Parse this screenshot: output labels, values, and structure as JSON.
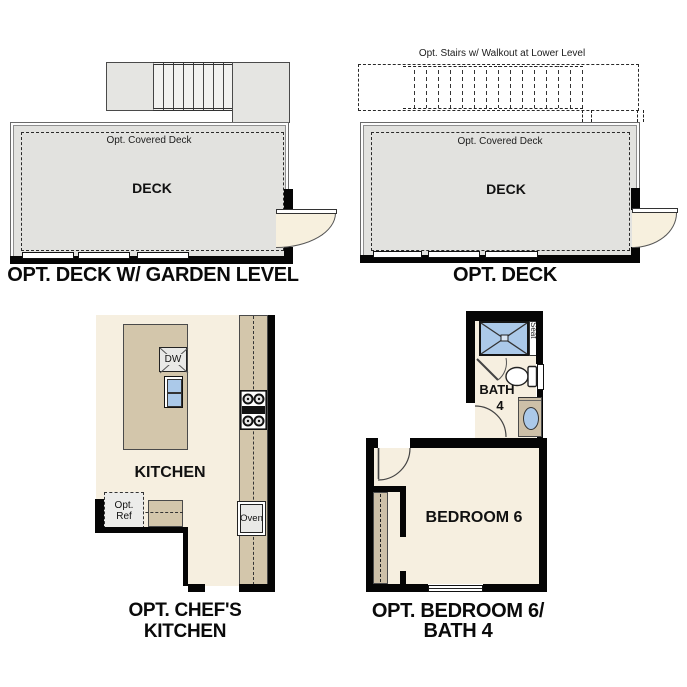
{
  "panels": {
    "deck_garden": {
      "title": "OPT. DECK W/ GARDEN LEVEL",
      "covered_label": "Opt. Covered Deck",
      "room_label": "DECK"
    },
    "deck": {
      "title": "OPT. DECK",
      "stairs_note": "Opt. Stairs w/ Walkout at Lower Level",
      "covered_label": "Opt. Covered Deck",
      "room_label": "DECK"
    },
    "chefs_kitchen": {
      "title_line1": "OPT. CHEF'S",
      "title_line2": "KITCHEN",
      "room_label": "KITCHEN",
      "dishwasher_label": "DW",
      "fridge_label_line1": "Opt.",
      "fridge_label_line2": "Ref",
      "oven_label": "Oven"
    },
    "bedroom6_bath4": {
      "title_line1": "OPT. BEDROOM 6/",
      "title_line2": "BATH 4",
      "bedroom_label": "BEDROOM 6",
      "bath_label_line1": "BATH",
      "bath_label_line2": "4",
      "seat_label": "Seat"
    }
  },
  "colors": {
    "wall": "#050505",
    "deck_fill": "#e2e2df",
    "floor_fill": "#f6efe0",
    "cabinet_fill": "#d3c6ab",
    "fixture_blue": "#abc9e9",
    "door_fill": "#f7f0de",
    "appliance_fill": "#e9e9e7"
  }
}
